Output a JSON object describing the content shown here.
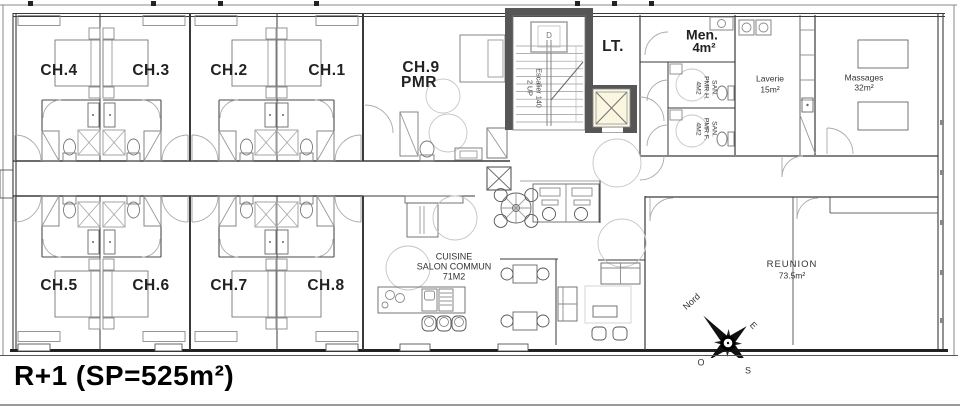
{
  "title": "R+1 (SP=525m²)",
  "labels": {
    "ch1": "CH.1",
    "ch2": "CH.2",
    "ch3": "CH.3",
    "ch4": "CH.4",
    "ch5": "CH.5",
    "ch6": "CH.6",
    "ch7": "CH.7",
    "ch8": "CH.8",
    "ch9_line1": "CH.9",
    "ch9_line2": "PMR",
    "lt": "LT.",
    "men_line1": "Men.",
    "men_line2": "4m²",
    "san_h_l1": "SAN.",
    "san_h_l2": "PMR H.",
    "san_h_l3": "4M2",
    "san_f_l1": "SAN.",
    "san_f_l2": "PMR F.",
    "san_f_l3": "4M2",
    "laverie_l1": "Laverie",
    "laverie_l2": "15m²",
    "massages_l1": "Massages",
    "massages_l2": "32m²",
    "cuisine_l1": "CUISINE",
    "cuisine_l2": "SALON COMMUN",
    "cuisine_l3": "71M2",
    "reunion_l1": "REUNION",
    "reunion_l2": "73.5m²",
    "escalier_l1": "Escalier 140",
    "escalier_l2": "2 UP",
    "stair_marker": "D"
  },
  "compass": {
    "north": "Nord",
    "east": "E",
    "west": "O",
    "south": "S"
  },
  "colors": {
    "wall": "#3a3a3a",
    "structure_dark": "#565656",
    "elevator_fill": "#faf6e0",
    "furniture": "#8a8a8a",
    "turning_circle": "#c6c6c6",
    "background": "#ffffff"
  }
}
